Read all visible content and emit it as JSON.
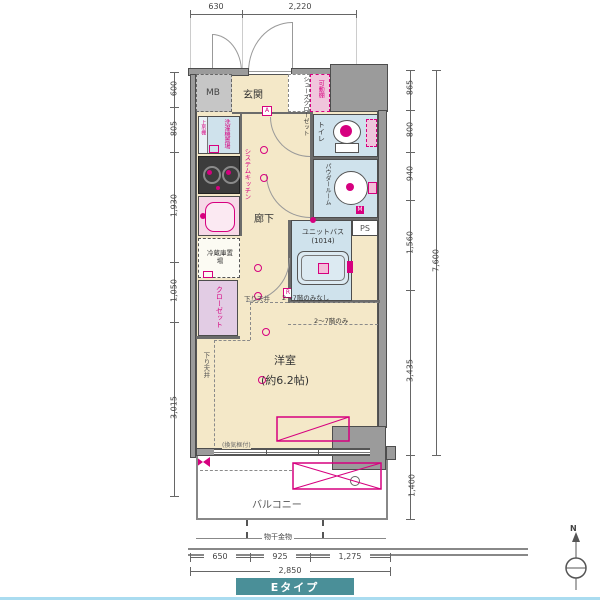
{
  "plan": {
    "type_label": "Eタイプ",
    "compass_label": "N",
    "rooms": {
      "mb": "MB",
      "genkan": "玄関",
      "shoes_closet": "シューズクローゼット",
      "movable_shelf": "可動棚",
      "toilet": "トイレ",
      "powder_room": "パウダールーム",
      "ps": "PS",
      "unit_bath": "ユニットバス",
      "unit_bath_size": "(1014)",
      "corridor": "廊下",
      "system_kitchen": "システムキッチン",
      "washer_place": "洗濯機置場",
      "upper_shelf": "上吊棚",
      "fridge_place": "冷蔵庫置場",
      "closet": "クローゼット",
      "main_room": "洋室",
      "main_room_size": "(約6.2帖)",
      "balcony": "バルコニー",
      "drying_fixture": "物干金物",
      "vent_note": "(換気框付)"
    },
    "notes": {
      "lowered_ceiling_side": "下り天井",
      "lowered_ceiling_top": "下り天井",
      "floors_note_1": "2〜7階のみなし",
      "floors_note_2": "2〜7階のみ"
    },
    "dims": {
      "top": [
        "630",
        "2,220"
      ],
      "left": [
        "600",
        "805",
        "1,930",
        "1,050",
        "3,015"
      ],
      "right": [
        "865",
        "800",
        "940",
        "1,560",
        "3,435"
      ],
      "right_total": "7,600",
      "right_balcony": "1,400",
      "bottom": [
        "650",
        "925",
        "1,275"
      ],
      "bottom_total": "2,850"
    },
    "chips": {
      "a": "A",
      "r": "R",
      "m": "M"
    }
  },
  "colors": {
    "floor_cream": "#f4e8c8",
    "wet_blue": "#cfe2ec",
    "accent_pink": "#d6007f",
    "closet_purple": "#e2cce4",
    "wall_gray": "#9b9b9b",
    "type_teal": "#4a8f98",
    "footer_blue": "#aadcf0"
  }
}
